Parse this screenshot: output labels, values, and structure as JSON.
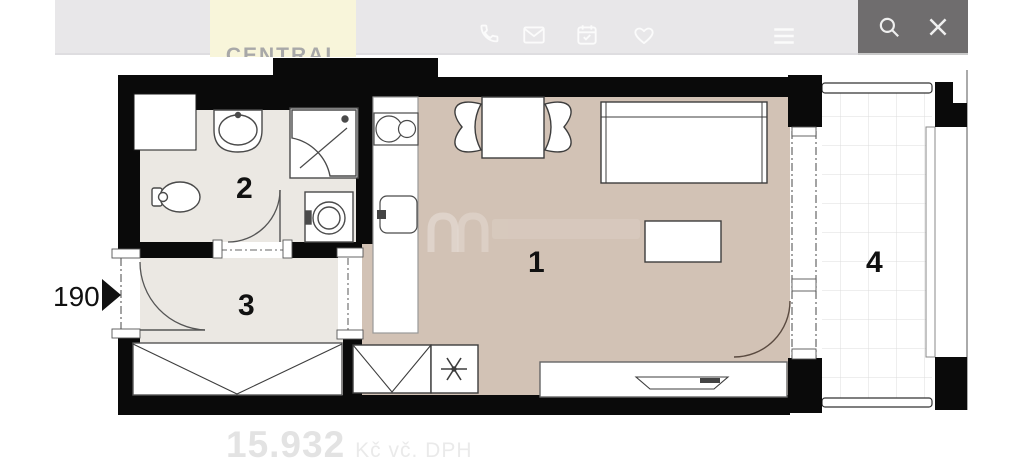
{
  "header": {
    "brand": "CENTRAL",
    "icons": [
      {
        "name": "phone-icon"
      },
      {
        "name": "mail-icon"
      },
      {
        "name": "calendar-icon"
      },
      {
        "name": "heart-icon"
      },
      {
        "name": "menu-icon"
      }
    ]
  },
  "viewer": {
    "search_icon": "search-icon",
    "close_icon": "close-icon"
  },
  "floorplan": {
    "rooms": [
      {
        "id": "living-room-kitchen",
        "number": "1"
      },
      {
        "id": "bathroom",
        "number": "2"
      },
      {
        "id": "entrance-hall",
        "number": "3"
      },
      {
        "id": "balcony",
        "number": "4"
      }
    ],
    "entrance_width_label": "190",
    "fixtures": [
      "sink",
      "corner-shower",
      "toilet",
      "washing-machine",
      "cooktop",
      "kitchen-sink",
      "dining-table",
      "chairs",
      "bed",
      "coffee-table",
      "wardrobe",
      "boiler",
      "tv-sideboard"
    ]
  },
  "price": {
    "amount": "15.932",
    "suffix": "Kč vč. DPH"
  },
  "colors": {
    "wall": "#0a0a0a",
    "floor_main": "#d2c2b5",
    "floor_wet": "#ebe8e3",
    "topbar_bg": "#e8e7e9",
    "panel_bg": "#6f6d6e",
    "brand_bg": "#f8f5da",
    "price_text": "#e3e3e3"
  }
}
